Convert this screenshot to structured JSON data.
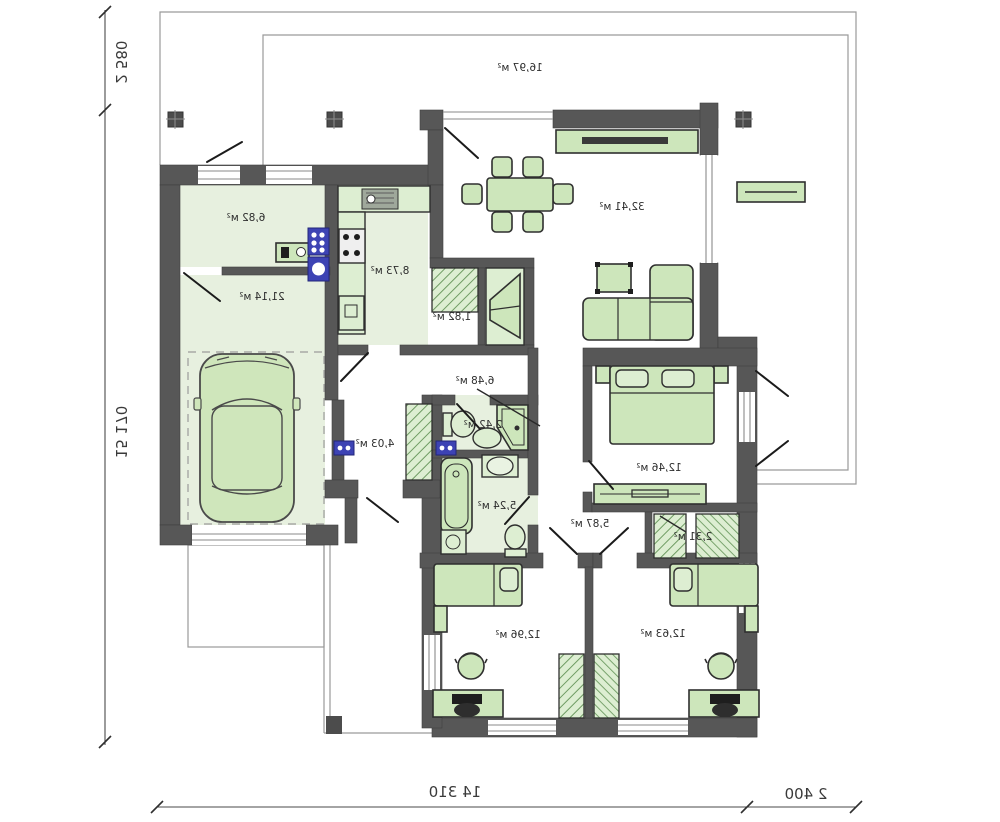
{
  "plan_title": "single-storey-house-floor-plan-mirrored",
  "rooms": [
    {
      "name": "terrace",
      "area": "16,97 м²"
    },
    {
      "name": "utility",
      "area": "6,82 м²"
    },
    {
      "name": "garage",
      "area": "21,14 м²"
    },
    {
      "name": "kitchen",
      "area": "8,73 м²"
    },
    {
      "name": "pantry",
      "area": "1,82 м²"
    },
    {
      "name": "living-room",
      "area": "32,41 м²"
    },
    {
      "name": "hallway",
      "area": "6,48 м²"
    },
    {
      "name": "wc",
      "area": "2,42 м²"
    },
    {
      "name": "entrance-hall",
      "area": "4,03 м²"
    },
    {
      "name": "bathroom",
      "area": "5,24 м²"
    },
    {
      "name": "bedroom-1",
      "area": "12,46 м²"
    },
    {
      "name": "inner-hall",
      "area": "5,87 м²"
    },
    {
      "name": "closet",
      "area": "2,31 м²"
    },
    {
      "name": "bedroom-2",
      "area": "12,96 м²"
    },
    {
      "name": "bedroom-3",
      "area": "12,63 м²"
    }
  ],
  "dimensions": {
    "left_top": "2 580",
    "left_main": "15 170",
    "bottom_main": "14 310",
    "bottom_right": "2 400"
  },
  "colors": {
    "wall": "#575757",
    "floor_green": "#e7f0df",
    "furniture_green": "#cde6bb",
    "appliance_blue": "#3d43b4",
    "site_line": "#9a9a9a",
    "text": "#2d2d2d"
  }
}
